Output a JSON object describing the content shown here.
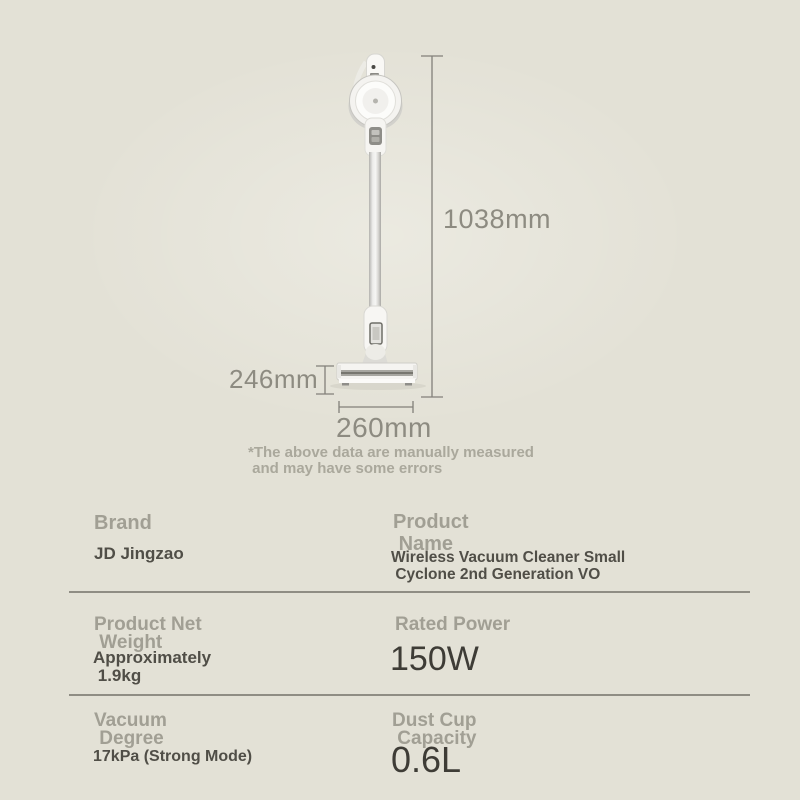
{
  "colors": {
    "page_background": "#e3e1d6",
    "label_gray": "#a19f94",
    "value_dark": "#504e47",
    "big_value_dark": "#3e3c36",
    "dimension_gray": "#8d8b81",
    "note_gray": "#aaa89c",
    "divider_gray": "#8f8d84",
    "product_white": "#f5f4f1"
  },
  "dimensions": {
    "height_label": "1038mm",
    "head_height_label": "246mm",
    "head_width_label": "260mm"
  },
  "note": {
    "line1": "*The above data are manually measured",
    "line2": " and may have some errors"
  },
  "specs": {
    "rows": [
      {
        "left": {
          "label": "Brand",
          "value": "JD Jingzao"
        },
        "right": {
          "label": "Product\n Name",
          "value": "Wireless Vacuum Cleaner Small\n Cyclone 2nd Generation VO"
        }
      },
      {
        "left": {
          "label": "Product Net\n Weight",
          "value": "Approximately\n 1.9kg"
        },
        "right": {
          "label": "Rated Power",
          "value": "150W"
        }
      },
      {
        "left": {
          "label": "Vacuum\n Degree",
          "value": "17kPa (Strong Mode)"
        },
        "right": {
          "label": "Dust Cup\n Capacity",
          "value": "0.6L"
        }
      }
    ]
  }
}
